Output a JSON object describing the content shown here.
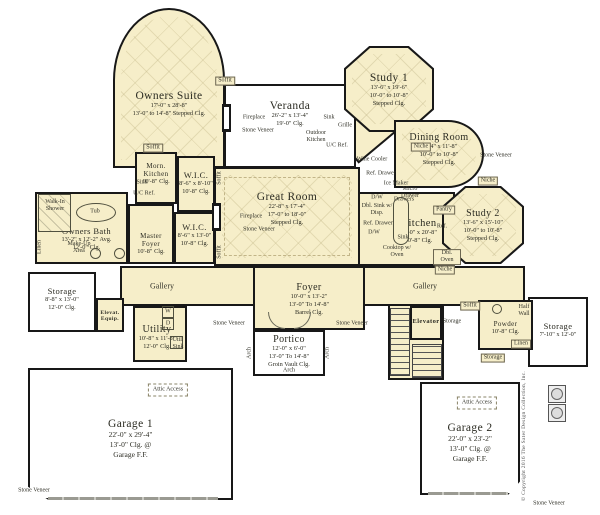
{
  "plan": {
    "type": "residential-floor-plan",
    "colors": {
      "room_fill": "#f6eec9",
      "wall": "#181818",
      "background": "#ffffff"
    },
    "rooms": [
      {
        "id": "owners-suite",
        "name": "Owners Suite",
        "dims": [
          "17'-0\" x 28'-8\"",
          "13'-0\" to 14'-8\" Stepped Clg."
        ]
      },
      {
        "id": "veranda",
        "name": "Veranda",
        "dims": [
          "26'-2\" x 13'-4\"",
          "19'-0\" Clg."
        ]
      },
      {
        "id": "study-1",
        "name": "Study 1",
        "dims": [
          "13'-6\" x 19'-6\"",
          "10'-0\" to 10'-8\"",
          "Stepped Clg."
        ]
      },
      {
        "id": "dining-room",
        "name": "Dining Room",
        "dims": [
          "17'-4\" x 11'-8\"",
          "10'-0\" to 10'-8\"",
          "Stepped Clg."
        ]
      },
      {
        "id": "great-room",
        "name": "Great Room",
        "dims": [
          "22'-8\" x 17'-4\"",
          "17'-0\" to 18'-0\"",
          "Stepped Clg."
        ]
      },
      {
        "id": "kitchen",
        "name": "Kitchen",
        "dims": [
          "20'-0\" x 20'-8\"",
          "10'-8\" Clg."
        ]
      },
      {
        "id": "study-2",
        "name": "Study 2",
        "dims": [
          "13'-6\" x 15'-10\"",
          "10'-0\" to 10'-8\"",
          "Stepped Clg."
        ]
      },
      {
        "id": "morn-kitchen",
        "name": "Morn. Kitchen",
        "dims": [
          "10'-8\" Clg."
        ]
      },
      {
        "id": "wic-1",
        "name": "W.I.C.",
        "dims": [
          "8'-6\" x 8'-10\"",
          "10'-8\" Clg."
        ]
      },
      {
        "id": "wic-2",
        "name": "W.I.C.",
        "dims": [
          "8'-6\" x 13'-0\"",
          "10'-8\" Clg."
        ]
      },
      {
        "id": "master-foyer",
        "name": "Master Foyer",
        "dims": [
          "10'-8\" Clg."
        ]
      },
      {
        "id": "owners-bath",
        "name": "Owners Bath",
        "dims": [
          "13'-2\" x 12'-2\" Avg.",
          "12'-0\" Clg."
        ]
      },
      {
        "id": "storage-left",
        "name": "Storage",
        "dims": [
          "8'-8\" x 13'-0\"",
          "12'-0\" Clg."
        ]
      },
      {
        "id": "elev-equip",
        "name": "Elevat. Equip.",
        "dims": []
      },
      {
        "id": "gallery-left",
        "name": "Gallery",
        "dims": []
      },
      {
        "id": "foyer",
        "name": "Foyer",
        "dims": [
          "10'-0\" x 13'-2\"",
          "13'-0\" To 14'-8\"",
          "Barrel Clg."
        ]
      },
      {
        "id": "gallery-right",
        "name": "Gallery",
        "dims": []
      },
      {
        "id": "utility",
        "name": "Utility",
        "dims": [
          "10'-8\" x 11'-8\"",
          "12'-0\" Clg."
        ]
      },
      {
        "id": "portico",
        "name": "Portico",
        "dims": [
          "12'-0\" x 6'-0\"",
          "13'-0\" To 14'-8\"",
          "Groin Vault Clg."
        ]
      },
      {
        "id": "elevator",
        "name": "Elevator",
        "dims": []
      },
      {
        "id": "powder",
        "name": "Powder",
        "dims": [
          "10'-8\" Clg."
        ]
      },
      {
        "id": "storage-right",
        "name": "Storage",
        "dims": [
          "7'-10\" x 12'-0\""
        ]
      },
      {
        "id": "garage-1",
        "name": "Garage 1",
        "dims": [
          "22'-0\" x 29'-4\"",
          "13'-0\" Clg. @",
          "Garage F.F."
        ]
      },
      {
        "id": "garage-2",
        "name": "Garage 2",
        "dims": [
          "22'-0\" x 23'-2\"",
          "13'-0\" Clg. @",
          "Garage F.F."
        ]
      }
    ],
    "callouts": [
      {
        "label": "Fireplace"
      },
      {
        "label": "Stone Veneer"
      },
      {
        "label": "Fireplace"
      },
      {
        "label": "Stone Veneer"
      },
      {
        "label": "Outdoor Kitchen"
      },
      {
        "label": "Grille"
      },
      {
        "label": "Sink"
      },
      {
        "label": "U/C Ref."
      },
      {
        "label": "Walk-In Shower"
      },
      {
        "label": "Tub"
      },
      {
        "label": "Make-Up Area"
      },
      {
        "label": "Linen"
      },
      {
        "label": "Sink"
      },
      {
        "label": "U/C Ref."
      },
      {
        "label": "Wine Cooler"
      },
      {
        "label": "Ref. Drawer"
      },
      {
        "label": "Ice Maker"
      },
      {
        "label": "Micro Drawer"
      },
      {
        "label": "D/W"
      },
      {
        "label": "Dbl. Sink w/ Disp."
      },
      {
        "label": "Ref. Drawer"
      },
      {
        "label": "D/W"
      },
      {
        "label": "Drawers"
      },
      {
        "label": "Sink"
      },
      {
        "label": "Pantry"
      },
      {
        "label": "Ref."
      },
      {
        "label": "Cooktop w/ Oven"
      },
      {
        "label": "Dbl. Oven"
      },
      {
        "label": "Niche"
      },
      {
        "label": "Niche"
      },
      {
        "label": "Stone Veneer"
      },
      {
        "label": "Niche"
      },
      {
        "label": "W"
      },
      {
        "label": "D"
      },
      {
        "label": "Util. Sink"
      },
      {
        "label": "Half Wall"
      },
      {
        "label": "Linen"
      },
      {
        "label": "Storage"
      },
      {
        "label": "Storage"
      },
      {
        "label": "Attic Access"
      },
      {
        "label": "Attic Access"
      },
      {
        "label": "Stone Veneer"
      },
      {
        "label": "Stone Veneer"
      },
      {
        "label": "Stone Veneer"
      },
      {
        "label": "Stone Veneer"
      },
      {
        "label": "Arch"
      },
      {
        "label": "Arch"
      },
      {
        "label": "Arch"
      },
      {
        "label": "Soffit"
      },
      {
        "label": "Soffit"
      },
      {
        "label": "Soffit"
      },
      {
        "label": "Soffit"
      },
      {
        "label": "Soffit"
      }
    ],
    "copyright": "© Copyright 2016 The Sater Design Collection, Inc."
  }
}
